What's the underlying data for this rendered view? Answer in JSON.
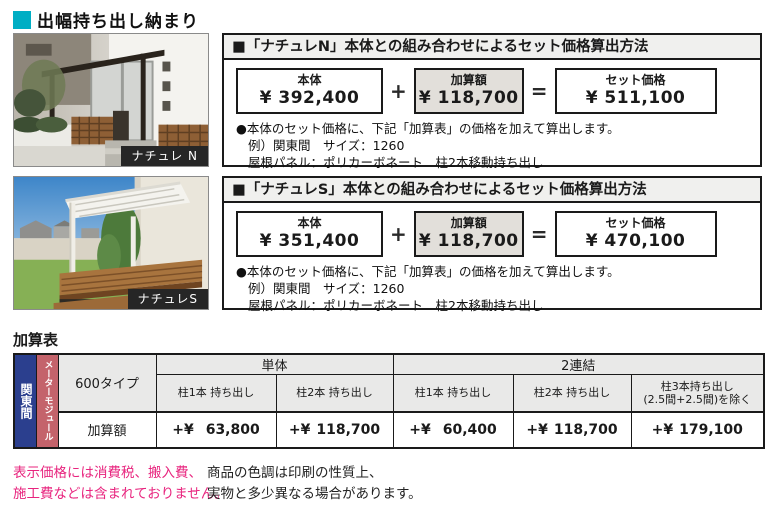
{
  "page_title": "出幅持ち出し納まり",
  "colors": {
    "accent_cyan": "#00AEC4",
    "magenta": "#E8247E",
    "strip_blue": "#2B3F8E",
    "strip_red": "#C4636B",
    "panel_title_bg": "#F0F0EE",
    "shaded_box_bg": "#E2DFDA",
    "table_header_bg": "#E9E9E8"
  },
  "photos": [
    {
      "label": "ナチュレ N"
    },
    {
      "label": "ナチュレS"
    }
  ],
  "panels": [
    {
      "title": "■「ナチュレN」本体との組み合わせによるセット価格算出方法",
      "box_main": {
        "label": "本体",
        "price": "¥ 392,400"
      },
      "box_add": {
        "label": "加算額",
        "price": "¥ 118,700"
      },
      "box_set": {
        "label": "セット価格",
        "price": "¥ 511,100"
      },
      "op_plus": "+",
      "op_equals": "=",
      "note_line1": "●本体のセット価格に、下記「加算表」の価格を加えて算出します。",
      "note_line2": "例）関東間　サイズ：1260",
      "note_line3": "屋根パネル：ポリカーボネート　柱2本移動持ち出し"
    },
    {
      "title": "■「ナチュレS」本体との組み合わせによるセット価格算出方法",
      "box_main": {
        "label": "本体",
        "price": "¥ 351,400"
      },
      "box_add": {
        "label": "加算額",
        "price": "¥ 118,700"
      },
      "box_set": {
        "label": "セット価格",
        "price": "¥ 470,100"
      },
      "op_plus": "+",
      "op_equals": "=",
      "note_line1": "●本体のセット価格に、下記「加算表」の価格を加えて算出します。",
      "note_line2": "例）関東間　サイズ：1260",
      "note_line3": "屋根パネル：ポリカーボネート　柱2本移動持ち出し"
    }
  ],
  "add_table": {
    "title": "加算表",
    "region_label": "関東間",
    "module_label": "メーターモジュール",
    "type_label": "600タイプ",
    "row_label": "加算額",
    "groups": [
      {
        "label": "単体"
      },
      {
        "label": "2連結"
      }
    ],
    "columns": [
      {
        "header": "柱1本 持ち出し",
        "value_prefix": "+¥",
        "value": "63,800"
      },
      {
        "header": "柱2本 持ち出し",
        "value_prefix": "+¥",
        "value": "118,700"
      },
      {
        "header": "柱1本 持ち出し",
        "value_prefix": "+¥",
        "value": "60,400"
      },
      {
        "header": "柱2本 持ち出し",
        "value_prefix": "+¥",
        "value": "118,700"
      },
      {
        "header": "柱3本持ち出し",
        "header_line2": "(2.5間+2.5間)を除く",
        "value_prefix": "+¥",
        "value": "179,100"
      }
    ]
  },
  "footer": {
    "magenta_line1": "表示価格には消費税、搬入費、",
    "magenta_line2": "施工費などは含まれておりません。",
    "black_line1": "商品の色調は印刷の性質上、",
    "black_line2": "実物と多少異なる場合があります。"
  }
}
